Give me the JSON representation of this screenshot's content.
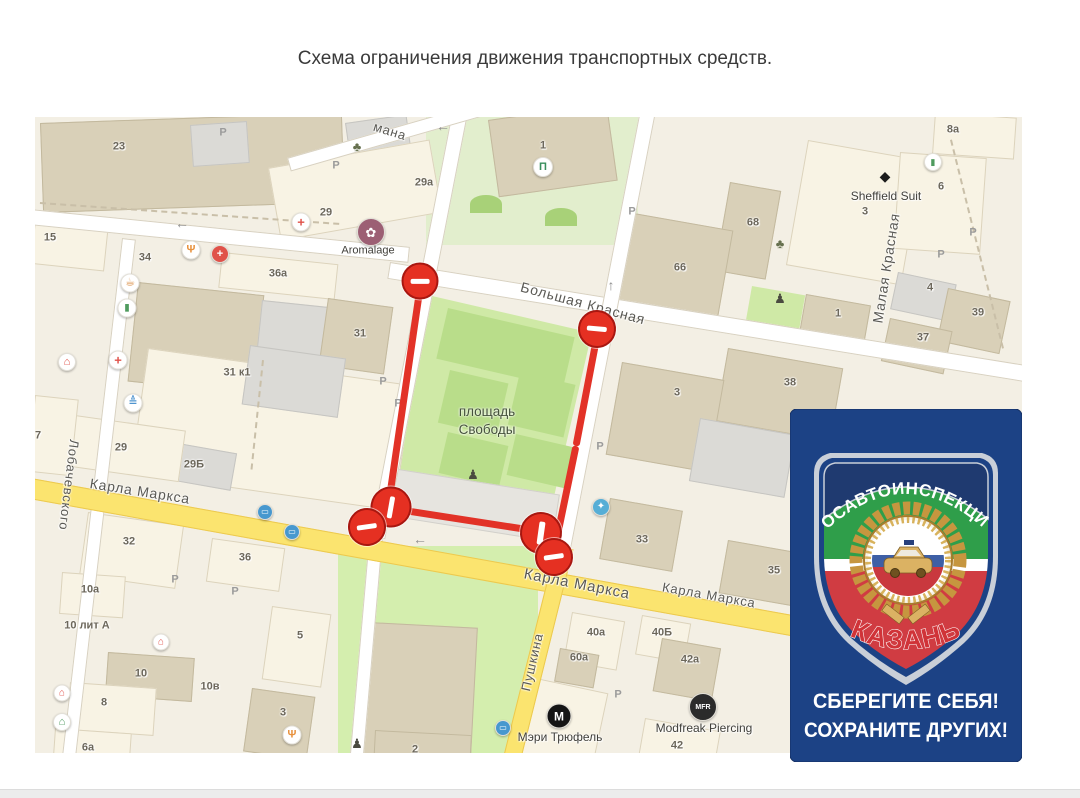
{
  "page": {
    "title": "Схема ограничения движения транспортных средств."
  },
  "map": {
    "colors": {
      "map_bg": "#f3efe4",
      "road_yellow": "#fbe46f",
      "park_green": "#cfe9a6",
      "restriction_red": "#e23227"
    },
    "street_labels": [
      {
        "text": "Большая Красная",
        "x": 583,
        "y": 303,
        "rot": 15,
        "size": 14
      },
      {
        "text": "Карла Маркса",
        "x": 140,
        "y": 491,
        "rot": 9,
        "size": 14
      },
      {
        "text": "Карла Маркса",
        "x": 577,
        "y": 584,
        "rot": 11,
        "size": 15
      },
      {
        "text": "Карла Маркса",
        "x": 709,
        "y": 595,
        "rot": 10,
        "size": 13
      },
      {
        "text": "Лобачевского",
        "x": 69,
        "y": 485,
        "rot": 97,
        "size": 13
      },
      {
        "text": "Малая Красная",
        "x": 886,
        "y": 268,
        "rot": -81,
        "size": 14
      },
      {
        "text": "Пушкина",
        "x": 532,
        "y": 662,
        "rot": -77,
        "size": 13
      },
      {
        "text": "мана",
        "x": 390,
        "y": 131,
        "rot": 17,
        "size": 13
      }
    ],
    "area_labels": [
      {
        "text": "площадь\nСвободы",
        "x": 487,
        "y": 421,
        "size": 13.5
      }
    ],
    "poi_labels": [
      {
        "text": "Aromalage",
        "x": 368,
        "y": 251,
        "size": 11
      },
      {
        "text": "Sheffield Suit",
        "x": 886,
        "y": 196,
        "size": 12
      },
      {
        "text": "Мэри Трюфель",
        "x": 560,
        "y": 737,
        "size": 12
      },
      {
        "text": "Modfreak Piercing",
        "x": 704,
        "y": 728,
        "size": 12
      }
    ],
    "house_numbers": [
      {
        "t": "23",
        "x": 119,
        "y": 147
      },
      {
        "t": "15",
        "x": 50,
        "y": 238
      },
      {
        "t": "34",
        "x": 145,
        "y": 258
      },
      {
        "t": "36а",
        "x": 278,
        "y": 274
      },
      {
        "t": "29",
        "x": 326,
        "y": 213
      },
      {
        "t": "29а",
        "x": 424,
        "y": 183
      },
      {
        "t": "1",
        "x": 543,
        "y": 146
      },
      {
        "t": "31",
        "x": 360,
        "y": 334
      },
      {
        "t": "31 к1",
        "x": 237,
        "y": 373
      },
      {
        "t": "29",
        "x": 121,
        "y": 448
      },
      {
        "t": "29Б",
        "x": 194,
        "y": 465
      },
      {
        "t": "32",
        "x": 129,
        "y": 542
      },
      {
        "t": "36",
        "x": 245,
        "y": 558
      },
      {
        "t": "7",
        "x": 38,
        "y": 436
      },
      {
        "t": "68",
        "x": 753,
        "y": 223
      },
      {
        "t": "66",
        "x": 680,
        "y": 268
      },
      {
        "t": "8а",
        "x": 953,
        "y": 130
      },
      {
        "t": "6",
        "x": 941,
        "y": 187
      },
      {
        "t": "3",
        "x": 865,
        "y": 212
      },
      {
        "t": "4",
        "x": 930,
        "y": 288
      },
      {
        "t": "39",
        "x": 978,
        "y": 313
      },
      {
        "t": "37",
        "x": 923,
        "y": 338
      },
      {
        "t": "1",
        "x": 838,
        "y": 314
      },
      {
        "t": "38",
        "x": 790,
        "y": 383
      },
      {
        "t": "3",
        "x": 677,
        "y": 393
      },
      {
        "t": "33",
        "x": 642,
        "y": 540
      },
      {
        "t": "35",
        "x": 774,
        "y": 571
      },
      {
        "t": "40а",
        "x": 596,
        "y": 633
      },
      {
        "t": "40Б",
        "x": 662,
        "y": 633
      },
      {
        "t": "60а",
        "x": 579,
        "y": 658
      },
      {
        "t": "42а",
        "x": 690,
        "y": 660
      },
      {
        "t": "42",
        "x": 677,
        "y": 746
      },
      {
        "t": "2",
        "x": 415,
        "y": 750
      },
      {
        "t": "10а",
        "x": 90,
        "y": 590
      },
      {
        "t": "10 лит А",
        "x": 87,
        "y": 626
      },
      {
        "t": "10",
        "x": 141,
        "y": 674
      },
      {
        "t": "10в",
        "x": 210,
        "y": 687
      },
      {
        "t": "8",
        "x": 104,
        "y": 703
      },
      {
        "t": "6а",
        "x": 88,
        "y": 748
      },
      {
        "t": "5",
        "x": 300,
        "y": 636
      },
      {
        "t": "3",
        "x": 283,
        "y": 713
      }
    ],
    "parking_glyph": "P",
    "parking_marks": [
      [
        223,
        133
      ],
      [
        336,
        166
      ],
      [
        632,
        212
      ],
      [
        973,
        233
      ],
      [
        941,
        255
      ],
      [
        383,
        382
      ],
      [
        398,
        404
      ],
      [
        600,
        447
      ],
      [
        175,
        580
      ],
      [
        235,
        592
      ],
      [
        618,
        695
      ]
    ],
    "arrows": [
      {
        "g": "←",
        "x": 182,
        "y": 223
      },
      {
        "g": "←",
        "x": 443,
        "y": 126
      },
      {
        "g": "↑",
        "x": 611,
        "y": 285
      },
      {
        "g": "←",
        "x": 420,
        "y": 539
      }
    ],
    "poi_icons": [
      {
        "n": "pharmacy-icon",
        "g": "+",
        "x": 301,
        "y": 222,
        "bg": "#ffffff",
        "fg": "#e0524a",
        "d": 17,
        "fs": 13
      },
      {
        "n": "pharmacy-icon",
        "g": "+",
        "x": 118,
        "y": 360,
        "bg": "#ffffff",
        "fg": "#e0524a",
        "d": 17,
        "fs": 13
      },
      {
        "n": "shop-icon",
        "g": "+",
        "x": 220,
        "y": 254,
        "bg": "#e0524a",
        "fg": "#ffffff",
        "d": 16,
        "fs": 11
      },
      {
        "n": "beauty-icon",
        "g": "✿",
        "x": 371,
        "y": 232,
        "bg": "#9c5f74",
        "fg": "#ffffff",
        "d": 26,
        "fs": 13
      },
      {
        "n": "restaurant-icon",
        "g": "Ψ",
        "x": 191,
        "y": 250,
        "bg": "#ffffff",
        "fg": "#e8923e",
        "d": 17,
        "fs": 11
      },
      {
        "n": "restaurant-icon",
        "g": "Ψ",
        "x": 292,
        "y": 735,
        "bg": "#ffffff",
        "fg": "#e8923e",
        "d": 17,
        "fs": 11
      },
      {
        "n": "cafe-icon",
        "g": "☕",
        "x": 130,
        "y": 283,
        "bg": "#ffffff",
        "fg": "#d98a3d",
        "d": 17,
        "fs": 11
      },
      {
        "n": "store-icon",
        "g": "▮",
        "x": 127,
        "y": 308,
        "bg": "#ffffff",
        "fg": "#4f9b5e",
        "d": 17,
        "fs": 10
      },
      {
        "n": "bank-icon",
        "g": "Π",
        "x": 543,
        "y": 167,
        "bg": "#ffffff",
        "fg": "#3a8f5d",
        "d": 18,
        "fs": 11
      },
      {
        "n": "grocery-icon",
        "g": "▮",
        "x": 933,
        "y": 162,
        "bg": "#ffffff",
        "fg": "#4f9b5e",
        "d": 16,
        "fs": 9
      },
      {
        "n": "fountain-icon",
        "g": "✦",
        "x": 601,
        "y": 507,
        "bg": "#56aed6",
        "fg": "#ffffff",
        "d": 16,
        "fs": 10
      },
      {
        "n": "bus-stop-icon",
        "g": "▭",
        "x": 265,
        "y": 512,
        "bg": "#4798cf",
        "fg": "#ffffff",
        "d": 14,
        "fs": 8
      },
      {
        "n": "bus-stop-icon",
        "g": "▭",
        "x": 292,
        "y": 532,
        "bg": "#4798cf",
        "fg": "#ffffff",
        "d": 14,
        "fs": 8
      },
      {
        "n": "bus-stop-icon",
        "g": "▭",
        "x": 503,
        "y": 728,
        "bg": "#4798cf",
        "fg": "#ffffff",
        "d": 14,
        "fs": 8
      },
      {
        "n": "monument-icon",
        "g": "♟",
        "x": 473,
        "y": 474,
        "bg": "none",
        "fg": "#4a4a40",
        "d": 14,
        "fs": 13
      },
      {
        "n": "monument-icon",
        "g": "♟",
        "x": 780,
        "y": 298,
        "bg": "none",
        "fg": "#4a4a40",
        "d": 14,
        "fs": 13
      },
      {
        "n": "monument-icon",
        "g": "♟",
        "x": 357,
        "y": 743,
        "bg": "none",
        "fg": "#4a4a40",
        "d": 14,
        "fs": 13
      },
      {
        "n": "tree-icon",
        "g": "♣",
        "x": 357,
        "y": 146,
        "bg": "none",
        "fg": "#66704e",
        "d": 14,
        "fs": 13
      },
      {
        "n": "tree-icon",
        "g": "♣",
        "x": 780,
        "y": 243,
        "bg": "none",
        "fg": "#66704e",
        "d": 14,
        "fs": 13
      },
      {
        "n": "hotel-icon",
        "g": "⌂",
        "x": 62,
        "y": 722,
        "bg": "#ffffff",
        "fg": "#4f9b5e",
        "d": 16,
        "fs": 11
      },
      {
        "n": "home-icon",
        "g": "⌂",
        "x": 67,
        "y": 362,
        "bg": "#ffffff",
        "fg": "#e0524a",
        "d": 16,
        "fs": 11
      },
      {
        "n": "home-icon",
        "g": "⌂",
        "x": 62,
        "y": 693,
        "bg": "#ffffff",
        "fg": "#e0524a",
        "d": 15,
        "fs": 10
      },
      {
        "n": "home-icon",
        "g": "⌂",
        "x": 161,
        "y": 642,
        "bg": "#ffffff",
        "fg": "#e0524a",
        "d": 15,
        "fs": 10
      },
      {
        "n": "education-icon",
        "g": "≜",
        "x": 133,
        "y": 403,
        "bg": "#ffffff",
        "fg": "#4f94cf",
        "d": 17,
        "fs": 11
      },
      {
        "n": "shield-icon",
        "g": "◆",
        "x": 885,
        "y": 176,
        "bg": "none",
        "fg": "#1c1c1c",
        "d": 16,
        "fs": 14
      },
      {
        "n": "brand-m-icon",
        "g": "М",
        "x": 559,
        "y": 716,
        "bg": "#151515",
        "fg": "#ffffff",
        "d": 23,
        "fs": 12
      },
      {
        "n": "brand-mfr-icon",
        "g": "MFR",
        "x": 703,
        "y": 707,
        "bg": "#2b2b2b",
        "fg": "#ffffff",
        "d": 26,
        "fs": 7
      }
    ],
    "restriction": {
      "signs": [
        {
          "x": 420,
          "y": 281,
          "d": 37,
          "bar": "h",
          "rot": 0
        },
        {
          "x": 597,
          "y": 329,
          "d": 38,
          "bar": "h",
          "rot": 5
        },
        {
          "x": 391,
          "y": 507,
          "d": 41,
          "bar": "v",
          "rot": 10
        },
        {
          "x": 367,
          "y": 527,
          "d": 38,
          "bar": "h",
          "rot": -8
        },
        {
          "x": 541,
          "y": 533,
          "d": 42,
          "bar": "v",
          "rot": 8
        },
        {
          "x": 554,
          "y": 557,
          "d": 38,
          "bar": "h",
          "rot": -8
        }
      ],
      "lines": [
        {
          "x1": 420,
          "y1": 288,
          "x2": 388,
          "y2": 508
        },
        {
          "x1": 597,
          "y1": 336,
          "x2": 576,
          "y2": 446
        },
        {
          "x1": 576,
          "y1": 446,
          "x2": 554,
          "y2": 552
        },
        {
          "x1": 388,
          "y1": 508,
          "x2": 543,
          "y2": 532
        }
      ]
    }
  },
  "badge": {
    "bg": "#1c4285",
    "arc_text": "ГОСАВТОИНСПЕКЦИЯ",
    "city": "КАЗАНЬ",
    "slogan_line1": "СБЕРЕГИТЕ СЕБЯ!",
    "slogan_line2": "СОХРАНИТЕ ДРУГИХ!"
  }
}
